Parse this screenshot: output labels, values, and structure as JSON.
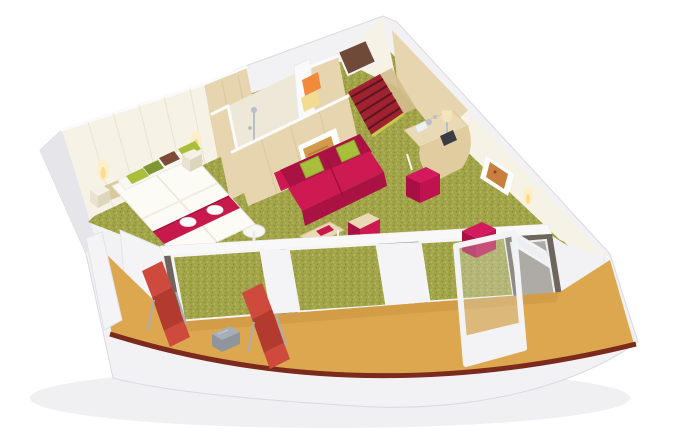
{
  "scene": {
    "type": "3d-cutaway-floorplan",
    "setting": "wedge-shaped ship suite with curved private balcony",
    "rooms": [
      {
        "name": "bedroom",
        "furnishings": [
          "two single beds pushed together",
          "white bedding",
          "red bed runner with two folded white towels",
          "green olive and brown accent pillows",
          "two nightstands",
          "two lit wall lamps",
          "white panelled headboard wall"
        ]
      },
      {
        "name": "bathroom",
        "furnishings": [
          "walk-in shower with chrome fittings",
          "white shower tray",
          "orange towel",
          "yellow towel",
          "light wood walls with white rims"
        ]
      },
      {
        "name": "entry-hall",
        "furnishings": [
          "dark entry door",
          "red runner carpet with dark stripes",
          "yellow threshold strip"
        ]
      },
      {
        "name": "living-area",
        "furnishings": [
          "magenta two-seat sofa",
          "two green cushions",
          "framed amber artwork above sofa",
          "wood-top coffee table with red tray",
          "magenta cube table",
          "curved wood desk with table lamp",
          "two magenta cube stools",
          "framed artwork on side wall",
          "lit wall sconce"
        ]
      },
      {
        "name": "balcony",
        "furnishings": [
          "two red sun loungers",
          "grey slatted side table",
          "ochre deck floor",
          "dark red railing trim",
          "glass wall with dark-framed panels",
          "open white-framed glass door"
        ]
      }
    ],
    "flooring": {
      "cabin": "olive-green speckled carpet",
      "entry": "red carpet with dark stripes",
      "balcony": "ochre deck"
    },
    "counts": {
      "beds": 2,
      "sun_loungers": 2,
      "sofa_cushions": 2,
      "stools": 2,
      "coffee_tables": 2
    }
  },
  "palette": {
    "outer_wall": "#f2f2f4",
    "outer_shade": "#e5e5ea",
    "outer_edge": "#d9d9df",
    "inner_cream": "#f6f2e6",
    "inner_shadow": "#eee8d8",
    "panel_line": "#ded7c3",
    "wood": "#e7d5b0",
    "wood_dark": "#d3bd8d",
    "wood_deep": "#bfa572",
    "carpet": "#a2a449",
    "carpet_dark": "#8b8d36",
    "carpet_light": "#c2c46a",
    "entry_red": "#9e2230",
    "entry_stripe": "#5e141d",
    "entry_yellow": "#c9c94a",
    "door_brown": "#6f4a38",
    "bed_white": "#fcfbf6",
    "bed_shade": "#e9e7da",
    "runner": "#c8194c",
    "runner_dark": "#a21140",
    "pillow_green": "#a9bf3c",
    "pillow_olive": "#7f9634",
    "pillow_brown": "#7c4a37",
    "sofa": "#ce1a52",
    "sofa_dark": "#a91243",
    "table_wood": "#ead9b5",
    "stool": "#d4195e",
    "stool_dark": "#a80f44",
    "stool_side": "#bf124e",
    "balcony_floor": "#dda750",
    "balcony_shade": "#c9923e",
    "fascia": "#7b2a1d",
    "lounger": "#cd4a3c",
    "lounger_dark": "#b23a2f",
    "metal": "#a8aeb5",
    "metal_dark": "#8f959c",
    "window_frame": "#6e665e",
    "white_post": "#f4f4f6",
    "glow": "#ffd98e",
    "glow_soft": "#ffeec6",
    "chrome": "#b9bfc6",
    "art_amber": "#d29a4b",
    "art_copper": "#c9803f",
    "white": "#ffffff",
    "near_white": "#fafafa",
    "tray": "#f6f6f2",
    "towel_orange": "#ef8b3b",
    "towel_yellow": "#f1dc92",
    "soft_shadow": "rgba(70,70,85,0.08)",
    "glass_tint": "rgba(238,240,238,0.5)",
    "door_glass": "rgba(219,224,221,0.3)"
  }
}
